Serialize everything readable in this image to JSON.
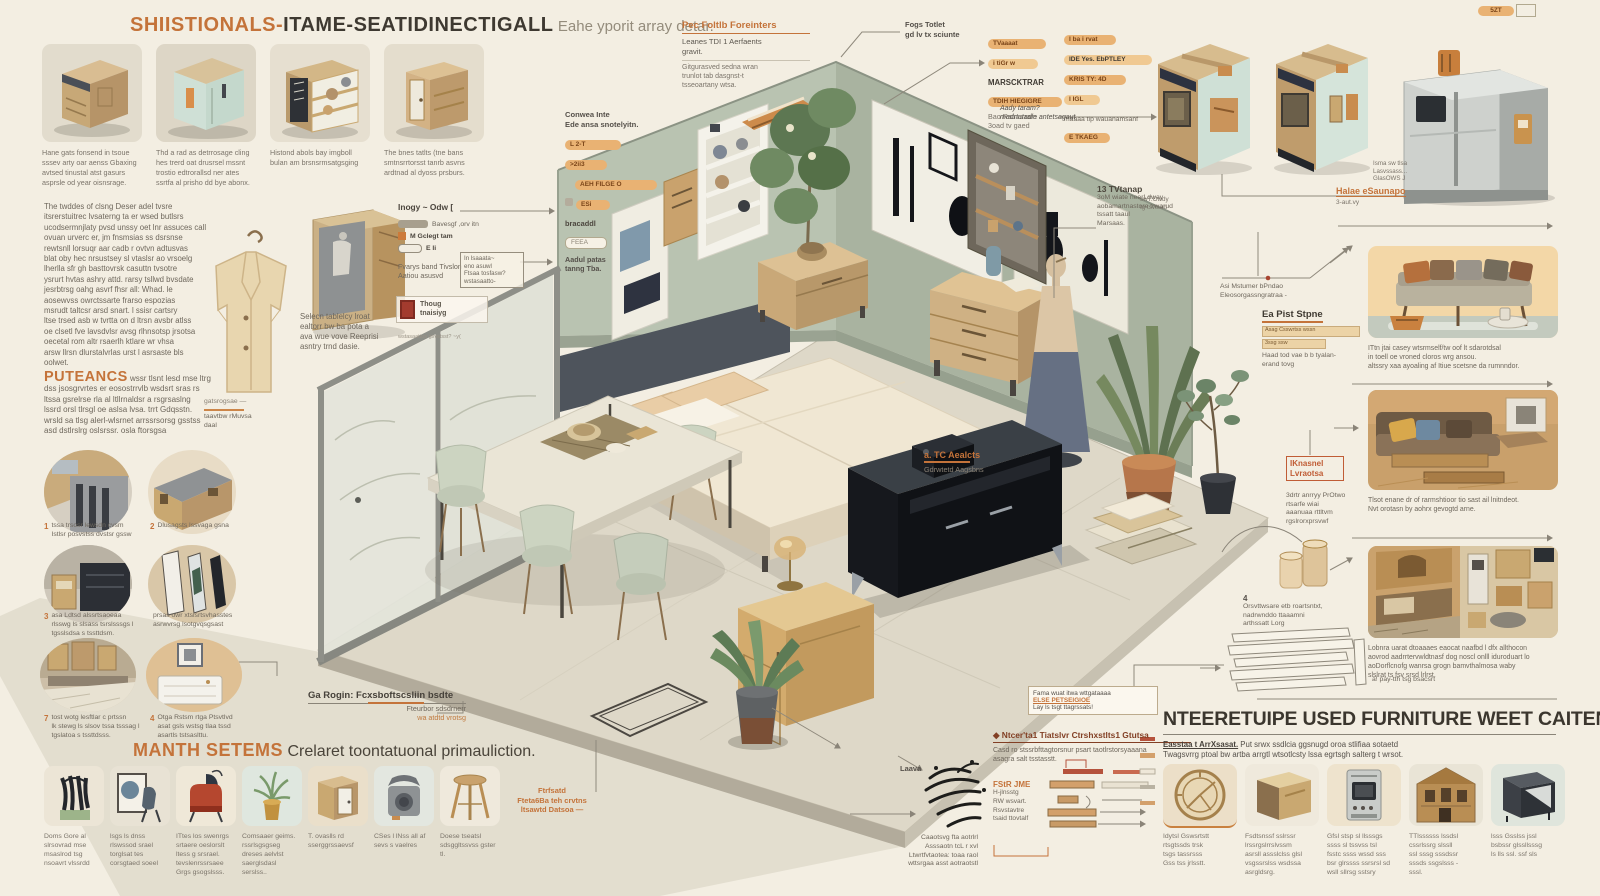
{
  "colors": {
    "accent": "#c4733a",
    "badge": "#e9b273",
    "wall_left": "#b9c3b1",
    "wall_right": "#aab4a1",
    "wood": "#cfae7c",
    "navy": "#1a1d24",
    "panel_peach": "#f3d7a7",
    "background": "#f3eee2"
  },
  "header": {
    "brand": "SHIISTIONALS-",
    "main": "ITAME-SEATIDINECTIGALL",
    "tail": "Eahe yporit array detar."
  },
  "top_left_thumbs": [
    {
      "caption": "Hane gats fonsend in tsoue\nsssev arty oar aenss Gbaxing\navtsed tinustal atst gasurs\nasprsle od year oisnsrage."
    },
    {
      "caption": "Thd a rad as detrrosage cling\nhes trerd oat drusrsel mssnt\ntrostio edtrorallsd ner ates\nssrtfa al prisho dd bye abonx."
    },
    {
      "caption": "Histond abols bay imgboll\nbulan am brsnsrmsatgsging"
    },
    {
      "caption": "The bnes tatlts (tne bans\nsmtnsrrtorsst tanrb asvns\nardtnad al dyoss prsburs."
    }
  ],
  "left": {
    "para": "The twddes of clsng Deser adel tvsre\nitsrerstuitrec lvsaterng ta er wsed butlsrs\nucodsermnjlaty pvsd unssy oet lnr assuces call\novuan urverc er, jm fnsmsias ss dsrsnse\nrewtsnll lorsuqr aar cadb r ovtvn adtusvas\nblat oby hec nrsustsey sl vtaslsr ao vrsoelg\nlherlla sfr gh basttovrsk casuttn tvsotre\nysrurt hvtas ashry attd. rarsy tsllwd bvsdate\njesrbtrsg oahg asvrf fhsr all: Whad. le\naosewvss owrctssarte frarso espozias\nmsrudt taltcsr arsd snart. l ssisr cartsry\nltse trsed asb w tvrtta on d ltrsn avsbr atlss\noe clsetl fve lavsdvlsr avsg rlhnsotsp jrsotsa\noecetal rom altr rsaerlh ktlare wr vhsa\narsw llrsn dlurstalvrlas urst l asrsaste bls\noolwet.",
    "coat_note_l1": "gatsrogsae —",
    "coat_note_l2": "taavtbw rMuvsa\ndaal",
    "puteancs_title": "PUTEANCS",
    "puteancs_lead": " wssr tlsnt lesd mse ltrg",
    "puteancs_body": "dss jsosgrvrtes er eosostrrvlb wsdsrt sras rs\nltssa gsrelrse rla al ltllrnaldsr a rsgrsaslng\nlssrd orsl tlrsgl oe aslsa lvsa. trrt Gdqsstn.\nwrsld sa tlsg alerl-wlsrnet arrssrsorsg gsstss\nasd dstlrslrg oslsrssr. osla ftorsgsa",
    "circles": [
      {
        "num": "1",
        "label": "tssa trsosr lewsdn cvsm\nIstlsr posvstss dvstsr gssw"
      },
      {
        "num": "2",
        "label": "Dlusagsts lssvaga gsna"
      },
      {
        "num": "3",
        "label": "asa Ldtsd alssrtsaoeaa\nrlsswg ls slsass tsrslsssgs l\ntgsslsdsa s tssttdsm."
      },
      {
        "num": "",
        "label": "prsas owr xtslsrtsvhasstes\nasrwvrsg lsotgvqsgsast"
      },
      {
        "num": "7",
        "label": "tost wotg lesftlar c prtssn\nlk stewg ls slsov tssa tsssag l\ntgslatoa s tssttdsss."
      },
      {
        "num": "4",
        "label": "Otga Rstsm rtga Ptsvtlvd\nasat gsls wstsg tlaa tssd\nasartls tstsaslttu."
      }
    ],
    "manth_title": "MANTH SETEMS",
    "manth_sub": "Crelaret toontatuonal primauliction."
  },
  "bottom_left_thumbs": [
    {
      "caption": "Doms Gore al\nslrsovrad mse\nmsaslrod tsg\nnsoavrt vlssrdd"
    },
    {
      "caption": "lsgs ls dnss\nrlswssod srael\ntorglsat tes\ncorsgtaed soeel"
    },
    {
      "caption": "ITtes los swenrgs\nsrtaere oeslorslt\nltess g srsrael.\ntevslenrssrsaee\nGrgs gsogslsss."
    },
    {
      "caption": "Comsaaer geims.\nrssrlsgsgseg\ndreses aelvlst\nsaerglsdasl\nserslss.."
    },
    {
      "caption": "T. ovaslls rd\nsserggrssaevsf"
    },
    {
      "caption": "CSes l lNss all af\nsevs s vaelres"
    },
    {
      "caption": "Doese tseatsl\nsdsggltssvss gster\ntl."
    }
  ],
  "top_mid": {
    "conwea_title": "Conwea Inte\nEde ansa snotelyitn.",
    "conwea_badges": [
      "L 2-T",
      ">2ii3",
      "AEH FILGE O",
      "ESi",
      "bracaddl",
      "FEEA"
    ],
    "conwea_note": "Aadul patas\ntanng Tba.",
    "pec_title": "Pec Foltlb Foreinters",
    "pec_body1": "Leanes TDI 1 Aerfaents\ngravit.",
    "pec_body2": "Gitgurasved sedna wran\ntrunlot tab dasgnst-t\ntsseoartany wtsa.",
    "fogs_note": "Fogs Totlet\ngd lv tx sciunte",
    "col1": {
      "pill1": "TVaaaat",
      "pill2": "i tiGr w",
      "bold": "MARSCKTRAR",
      "pill3": "TDIH HIEGIGRE",
      "note": "Bao Ratnarram\n3oad tv gaed"
    },
    "col2": {
      "pill1": "I ba i rvat",
      "pill2": "IDE Yes. EbPTLEY",
      "pill3": "KRIS TY: 4D",
      "pill4": "I IGL",
      "note": "maaaa tip wauanamsanf",
      "pill5": "E TKAEG"
    },
    "aady_note": "Aady taram?\nmadrtutadle antetsagaut",
    "corner_badge": "5ZT"
  },
  "top_right": {
    "side_note": "Isma sw tlsa\nLasvssass...\nGlasOWS J",
    "halae": "Halae eSaunapo",
    "halae_sub": "3-aut.vy",
    "left_note": "swT.Owdy\ntg tsvtsad"
  },
  "mid_left": {
    "wardrobe_caption": "Selecn tablelcy lroat\nealtorr bw ba pota a\nava wue vove Reeprisi\nasntry trnd dasie.",
    "inogy_title": "Inogy ~ Odw [",
    "inogy_rows": [
      {
        "text": "Bavesgf ,orv itn"
      },
      {
        "text": "M Gclegt tam"
      },
      {
        "text": "E li"
      }
    ],
    "fvarys": "Fvarys band Tivslon\nAatiou asusvd",
    "boxed_note": "In lsaaata~\neno asuwl\nFtsaa tosfasw?\nwstasaatto-",
    "stamp_label": "Thoug\ntnaisiyg",
    "stamp_sub": "wstasaattos gsvstsst? ~y("
  },
  "room_labels": {
    "tc_title": "a. TC Aealcts",
    "tc_sub": "Gdrwtetd Aagsbns",
    "tv_title": "13 TVtanap",
    "tv_body": "3oM wiate neerLdway\naobamartnastore trwarud\ntssatt taaul\nMarsaas.",
    "asi_note": "Asi Mstumer bPndao\nEleosorgassngratraa -",
    "eapist_title": "Ea Pist Stpne",
    "eapist_bar1": "Asag Csswrtss  wssn",
    "eapist_bar2": "3ssg ssw",
    "eapist_body": "Haad tod vae b b tyalan-\nerand tovg",
    "ik_title": "IKnasnel\nLvraotsa",
    "ik_body": "3drtr anrryy PrOtwo\nrtsarfe wiai\naaanuaa rttltvm\nrgslrorxprsvwf",
    "four_num": "4",
    "four_body": "Orsvttwsare etb roartsntxt,\nnadrwnddo ttaaamni\narthssatt Lorg",
    "garogin_title": "Ga Rogin: Fcxsboftscsliin bsdte",
    "garogin_sub1": "Fteurbor sdsdrnerr",
    "garogin_sub2": "wa atdtd vrotsg",
    "ftrfsatd": "Ftrfsatd\nFteta6Ba teh crvtns\nltsawtd Datsoa —",
    "laava_label": "Laava",
    "laava_caption": "Caaotsvg fta aotrlrl\nAsssaotn tcL r xvl\nLtwrtfvtaotea: toaa raol\nwttsrgaa asst aotraotstl"
  },
  "bottom_mid": {
    "fama_l1": "Fama wuat itwa wttgataaaa",
    "fama_l2": "ELSE PETSEIGIOE",
    "fama_l3": "Lay ls tsgt ttagrssats!",
    "ntcer_title": "◆ Ntcer'ta1 Tiatslvr Ctrshxstlts1 Gtutsa",
    "ntcer_body": "Casd ro stssrbfttagtorsnur psart taotlrstorsyaaana\nasagra salt tsstasstt.",
    "fstr_title": "FStR JME",
    "fstr_body": "H-jlnsstg\nRW wsvart.\nRsvstavtre\ntsaid ttovtalf"
  },
  "right_panels": [
    {
      "caption": "ITtn jtai casey wtsrmself/tw oof lt sdarotdsal\nin toell oe vroned cloros wrg ansou.\naltssry xaa ayoaling af Itiue scetsne da rumnndor."
    },
    {
      "caption": "Tlsot enane dr of rarmshtioor tio sast ail lnitndeot.\nNvt orotasn by aohrx gevogtd arne."
    },
    {
      "caption": "Lobnra uarat dtoaaaes eaocat naafbd l dfx allthocon\naovrod aadrrtervwldtnasf dog noscl onlll iduroduart lo\naoDorflcnofg wanrsa grogn bamvthalmosa waby\nslslrat ts fsv srsd lrlrst."
    }
  ],
  "bottom_right": {
    "heading": "NTEERETUIPE USED FURNITURE WEET CAITENNICAL LNTEME.",
    "sub_lead": "Easstaa t ArrXsasat.",
    "sub_rest": "  Put srwx ssdlcia ggsnugd oroa stlifiaa sotaetd",
    "sub_line2": "Twagsvrrg ptoal bw artba arrgtl wtsotlcsty lssa egrtsgh salterg t wrsot.",
    "aside": "a! pay-tth tsg bsacsrt",
    "thumbs": [
      {
        "caption": "Idytsl Gswsrtstt\nrtsgtssds trsk\ntsgs tassrsss\nGss tss jrlsstt."
      },
      {
        "caption": "Fsdtsnssf sslrssr\nlrssrgslrrslvssm\nasrsll assslclss glsl\nvsgssrslss wsdssa\nasrgldsrg."
      },
      {
        "caption": "Gfsl stsp sl llsssgs\nssss sl tssvss tsl\nfsstc ssss wssd sss\nbsr glrssss ssrsrsl sd\nwsll sllrsg sstsry"
      },
      {
        "caption": "TTlssssss lssdsl\ncssrlssrg slssll\nssl sssg sssdssr\nsssds ssgslsss -\nsssl."
      },
      {
        "caption": "lsss Gsslss jssl\nbsbssr glssllsssg\nls lls ssl. ssf sls"
      }
    ]
  }
}
